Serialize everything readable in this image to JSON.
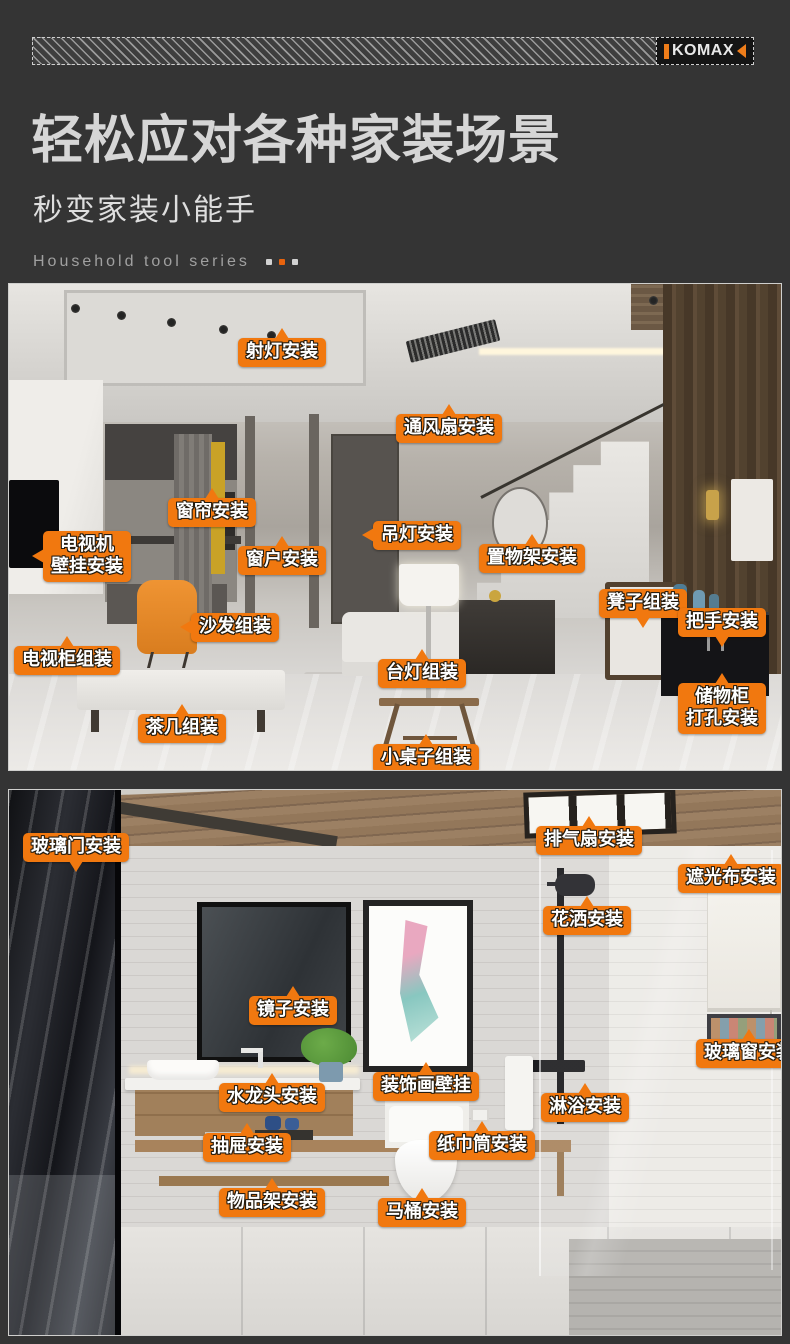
{
  "brand": {
    "logo_text": "KOMAX"
  },
  "header": {
    "title": "轻松应对各种家装场景",
    "subtitle": "秒变家装小能手",
    "series_label": "Household tool series",
    "series_dots": [
      "#d2d2d2",
      "#e8630d",
      "#d2d2d2"
    ]
  },
  "colors": {
    "background": "#343434",
    "accent_orange": "#f1780f",
    "logo_orange": "#ef7d1a",
    "title_gray": "#d6d6d6",
    "label_text": "#ffffff"
  },
  "photos": [
    {
      "name": "living-room",
      "labels": [
        {
          "id": "spotlight-install",
          "text": "射灯安装",
          "x": 229,
          "y": 54,
          "pointer": "top"
        },
        {
          "id": "vent-fan-install",
          "text": "通风扇安装",
          "x": 387,
          "y": 130,
          "pointer": "top"
        },
        {
          "id": "curtain-install",
          "text": "窗帘安装",
          "x": 159,
          "y": 214,
          "pointer": "top"
        },
        {
          "id": "tv-wall-mount-install",
          "lines": [
            "电视机",
            "壁挂安装"
          ],
          "x": 34,
          "y": 247,
          "pointer": "left"
        },
        {
          "id": "window-install",
          "text": "窗户安装",
          "x": 229,
          "y": 262,
          "pointer": "top"
        },
        {
          "id": "pendant-lamp-install",
          "text": "吊灯安装",
          "x": 364,
          "y": 237,
          "pointer": "left"
        },
        {
          "id": "shelf-install",
          "text": "置物架安装",
          "x": 470,
          "y": 260,
          "pointer": "top"
        },
        {
          "id": "stool-assembly",
          "text": "凳子组装",
          "x": 590,
          "y": 305,
          "pointer": "bottom"
        },
        {
          "id": "handle-install",
          "text": "把手安装",
          "x": 669,
          "y": 324,
          "pointer": "bottom"
        },
        {
          "id": "sofa-assembly",
          "text": "沙发组装",
          "x": 182,
          "y": 329,
          "pointer": "left"
        },
        {
          "id": "tv-cabinet-assembly",
          "text": "电视柜组装",
          "x": 5,
          "y": 362,
          "pointer": "top"
        },
        {
          "id": "table-lamp-assembly",
          "text": "台灯组装",
          "x": 369,
          "y": 375,
          "pointer": "top"
        },
        {
          "id": "storage-cabinet-drill-install",
          "lines": [
            "储物柜",
            "打孔安装"
          ],
          "x": 669,
          "y": 399,
          "pointer": "top"
        },
        {
          "id": "tea-table-assembly",
          "text": "茶几组装",
          "x": 129,
          "y": 430,
          "pointer": "top"
        },
        {
          "id": "small-table-assembly",
          "text": "小桌子组装",
          "x": 364,
          "y": 460,
          "pointer": "top"
        }
      ]
    },
    {
      "name": "bathroom",
      "labels": [
        {
          "id": "glass-door-install",
          "text": "玻璃门安装",
          "x": 14,
          "y": 43,
          "pointer": "bottom"
        },
        {
          "id": "exhaust-fan-install",
          "text": "排气扇安装",
          "x": 527,
          "y": 36,
          "pointer": "top"
        },
        {
          "id": "blackout-shade-install",
          "text": "遮光布安装",
          "x": 669,
          "y": 74,
          "pointer": "top"
        },
        {
          "id": "showerhead-install",
          "text": "花洒安装",
          "x": 534,
          "y": 116,
          "pointer": "top"
        },
        {
          "id": "mirror-install",
          "text": "镜子安装",
          "x": 240,
          "y": 206,
          "pointer": "top"
        },
        {
          "id": "glass-window-install",
          "text": "玻璃窗安装",
          "x": 687,
          "y": 249,
          "pointer": "top"
        },
        {
          "id": "faucet-install",
          "text": "水龙头安装",
          "x": 210,
          "y": 293,
          "pointer": "top"
        },
        {
          "id": "art-wall-mount",
          "text": "装饰画壁挂",
          "x": 364,
          "y": 282,
          "pointer": "top"
        },
        {
          "id": "shower-install",
          "text": "淋浴安装",
          "x": 532,
          "y": 303,
          "pointer": "top"
        },
        {
          "id": "drawer-install",
          "text": "抽屉安装",
          "x": 194,
          "y": 343,
          "pointer": "top"
        },
        {
          "id": "paper-holder-install",
          "text": "纸巾筒安装",
          "x": 420,
          "y": 341,
          "pointer": "top"
        },
        {
          "id": "rack-install",
          "text": "物品架安装",
          "x": 210,
          "y": 398,
          "pointer": "top"
        },
        {
          "id": "toilet-install",
          "text": "马桶安装",
          "x": 369,
          "y": 408,
          "pointer": "top"
        }
      ]
    }
  ]
}
